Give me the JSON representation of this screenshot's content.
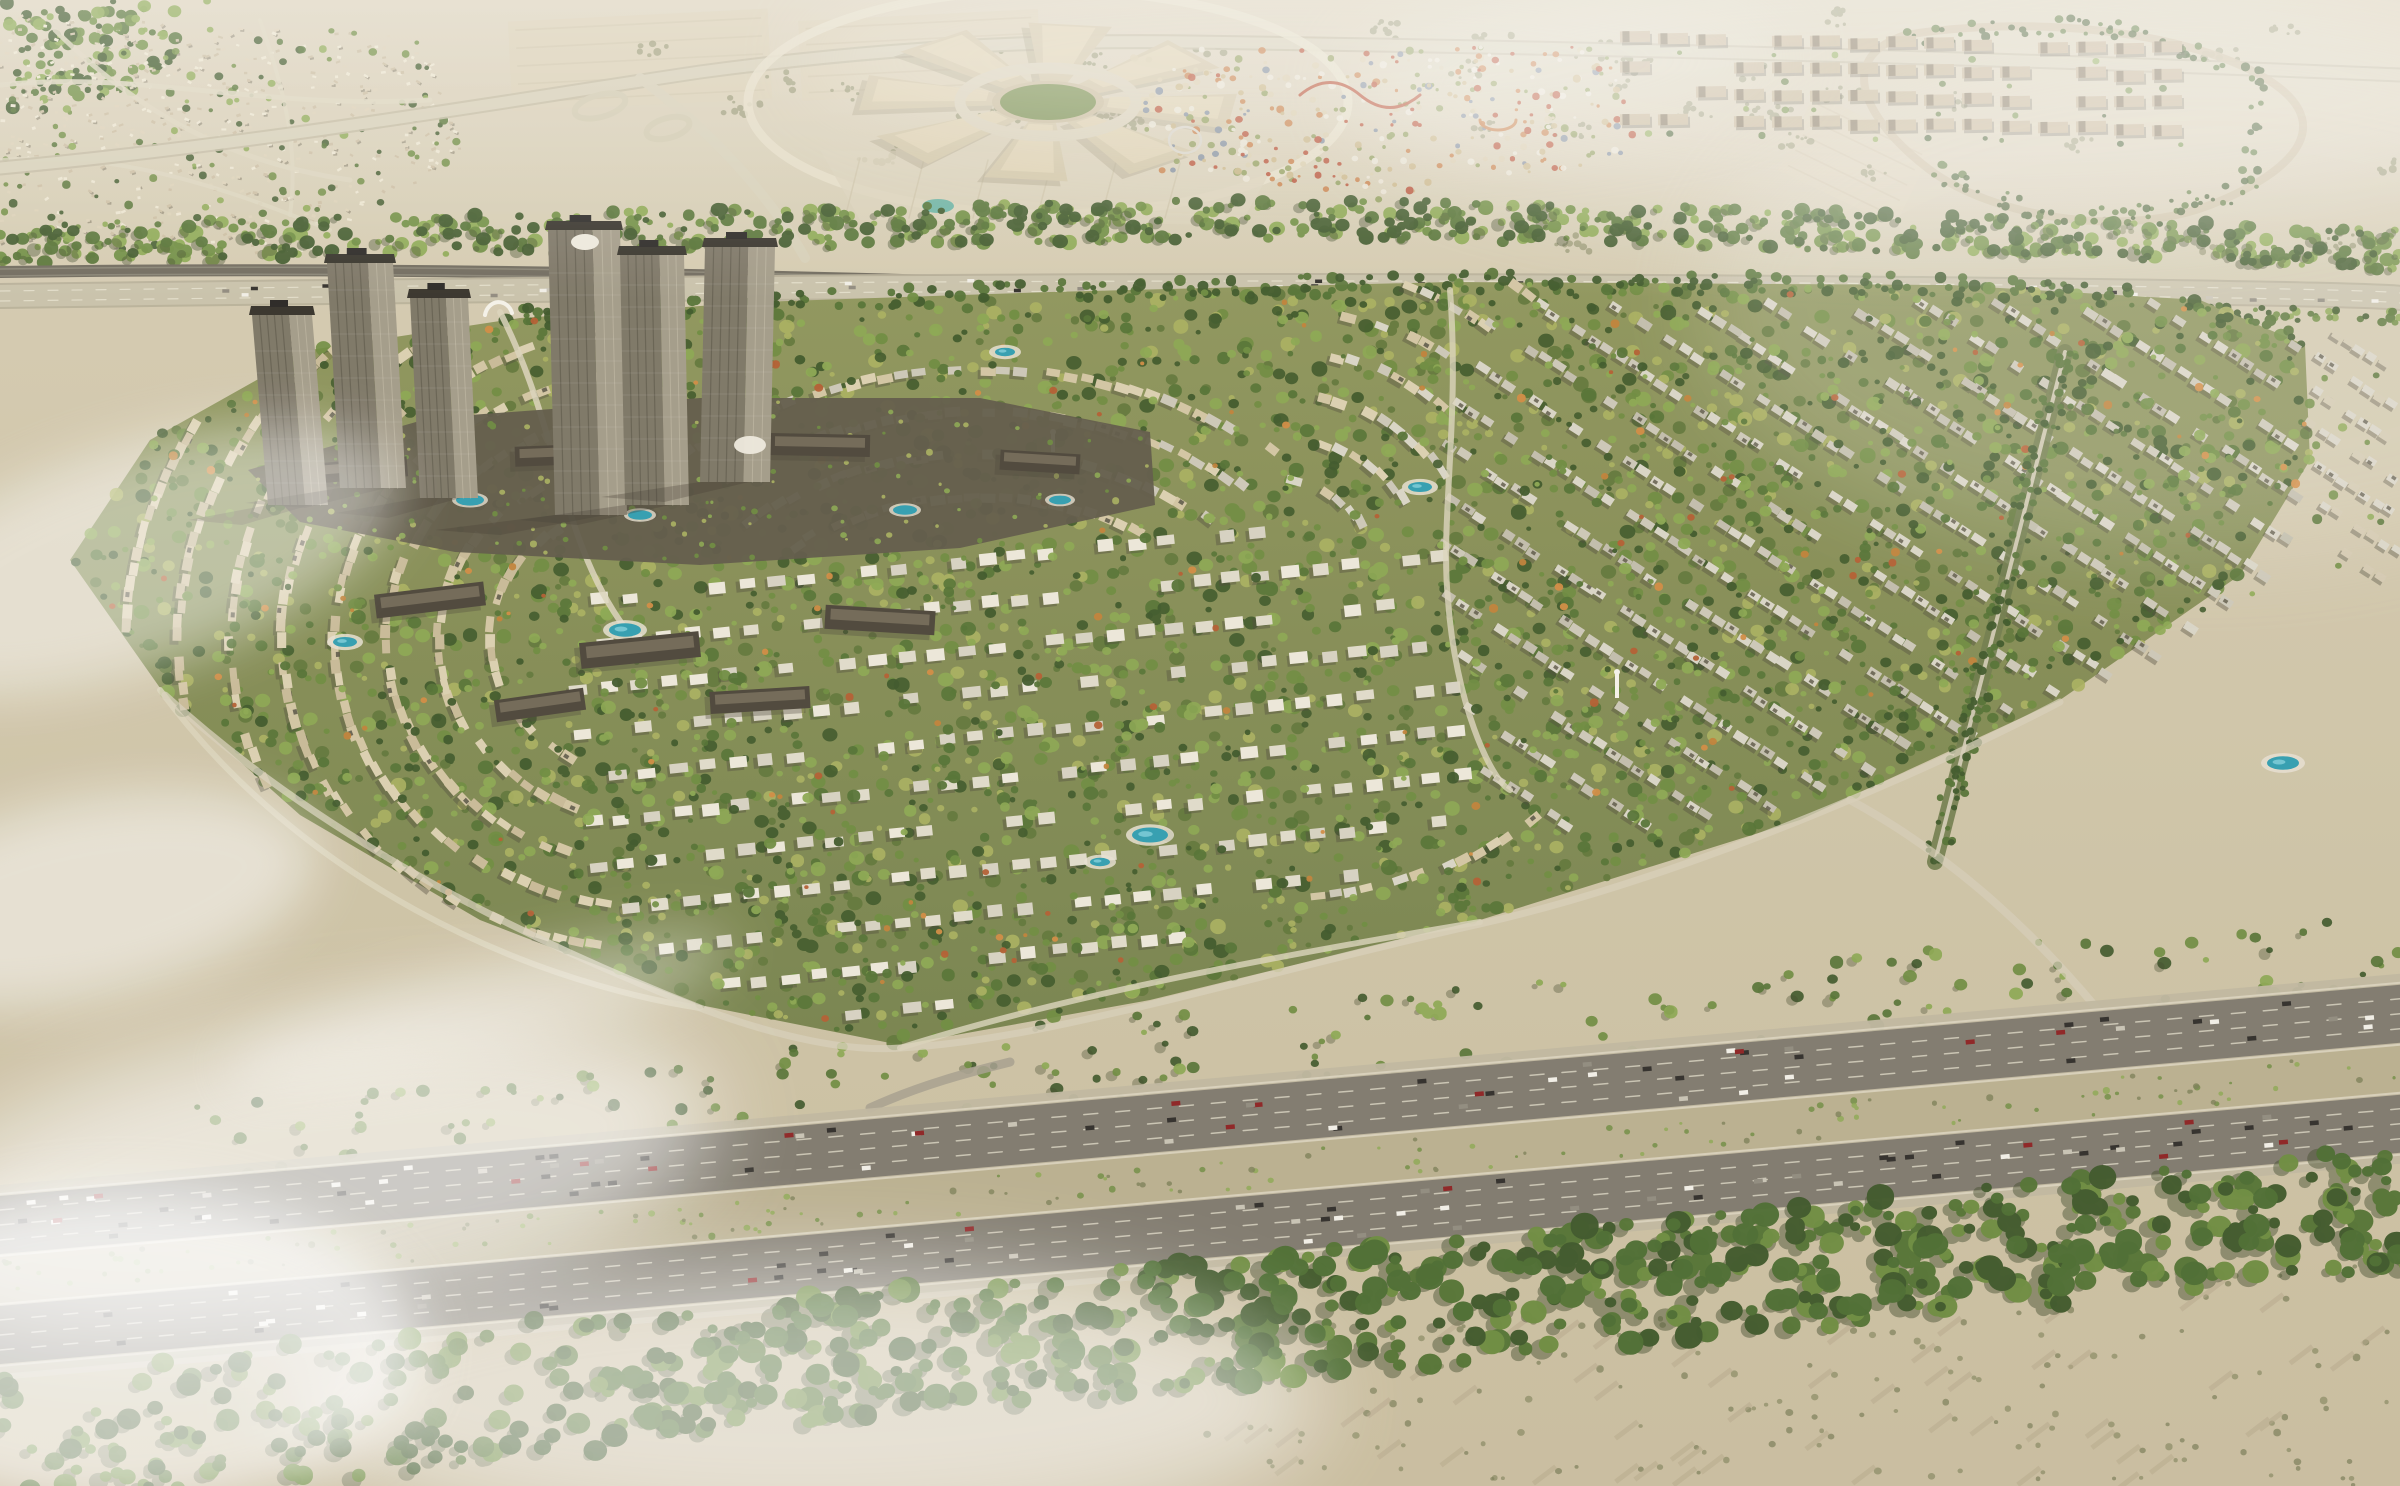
{
  "image": {
    "type": "aerial-architectural-render",
    "description": "Aerial render of a large master-planned desert residential community: crescent-shaped rows of beige townhouses and white villas with dense green landscaping, a cluster of high-rise towers on a podium beside a metro rail line, a circular shopping mall and colorful theme park on the upper desert plain, an eight-lane highway with heavy traffic and a forest belt in the foreground, with haze and low clouds at the edges.",
    "width": 2400,
    "height": 1486
  },
  "palette": {
    "sandTop": "#dad0b8",
    "sand": "#cfc5a9",
    "sandWarm": "#d7c9ac",
    "sandBottom": "#c9bc9e",
    "oliveField": "#abaa7c",
    "oliveField2": "#b7b488",
    "treeDark": "#3c5526",
    "tree": "#527030",
    "treeMid": "#6b8a3c",
    "treeLight": "#8aa64e",
    "treeYellow": "#a9af5c",
    "autumn": "#c07f35",
    "autumnRed": "#b25b2d",
    "communityBase1": "#8e9459",
    "communityBase2": "#76814a",
    "houseBeige1": "#dbcfae",
    "houseBeige2": "#d2c4a1",
    "houseBeige3": "#c8b995",
    "houseGray1": "#d9d4c5",
    "houseGray2": "#ccc7b6",
    "houseGray3": "#c1bcaa",
    "villaWhite1": "#ece7d8",
    "villaWhite2": "#e0dbc9",
    "villaWhite3": "#d6d1c0",
    "roofDark": "#55503f",
    "shadow": "#4b4636",
    "roadLight": "#dcd4bb",
    "roadCasing": "#c2b99e",
    "roadTop": "#d7cfb6",
    "asphalt": "#7e786b",
    "asphaltShoulder": "#bfb69e",
    "laneLine": "#e9e3cf",
    "railDark": "#6e685a",
    "stationGray": "#a39c88",
    "towerFront": "#7b7463",
    "towerSide": "#a29a86",
    "towerCap": "#332f26",
    "towerStripe": "#575243",
    "podium": "#5e5746",
    "podiumBar": "#4a4336",
    "podiumBarTop": "#6f6653",
    "mallBody": "#d2c5a5",
    "mallTop": "#ddd0af",
    "mallRing": "#d9d0b7",
    "mallGreen": "#7a8f4e",
    "mallShadow": "#9d9176",
    "parkOrange": "#c77a40",
    "parkRed": "#b64a2e",
    "parkWhite": "#e9e2d1",
    "parkBlue": "#7d8a9a",
    "pool": "#2f9cae",
    "poolLight": "#7fd0da",
    "poolDeck": "#e6dfd0",
    "pond": "#5fae9e",
    "carDark": "#2e2b26",
    "carWhite": "#f2efe6",
    "carGray": "#8f897c",
    "carRed": "#8c1f1f",
    "carSilver": "#c8c2b3",
    "fog": "#ffffff",
    "haze": "#f3eee1",
    "shrub": "#7a7d54",
    "medianScrub": "#b9ae8d",
    "fieldLine": "#cfc3a6",
    "archWhite": "#f5f2e8"
  },
  "scene": {
    "regions": [
      {
        "id": "desert-plain",
        "label": "hazy desert plain with shrub patches"
      },
      {
        "id": "existing-community",
        "label": "existing villa community at top left"
      },
      {
        "id": "highway-interchange",
        "label": "road interchange with loop ramps"
      },
      {
        "id": "shopping-mall",
        "label": "radial shopping mall with central ring"
      },
      {
        "id": "theme-park",
        "label": "theme park with colorful rides"
      },
      {
        "id": "apartment-rows",
        "label": "rows of tan apartment blocks"
      },
      {
        "id": "tree-belt",
        "label": "green tree belt along the corridor"
      },
      {
        "id": "metro-rail",
        "label": "metro rail line and arterial road"
      },
      {
        "id": "tower-cluster",
        "label": "high-rise towers on podium with pools"
      },
      {
        "id": "villa-community",
        "label": "master-planned community with crescent streets"
      },
      {
        "id": "main-highway",
        "label": "eight-lane highway with traffic and scrub median"
      },
      {
        "id": "forest-belt",
        "label": "dense forest belt in foreground"
      },
      {
        "id": "fog",
        "label": "low clouds and haze"
      }
    ],
    "counts": {
      "mottleDots": 2800,
      "communityTrees": 950,
      "autumnTrees": 170,
      "beltTrees": 760,
      "hedgeTrees": 260,
      "forestTrees": 650,
      "forestTreesLeft": 130,
      "stripTrees": 170,
      "desertShrubClusters": 46,
      "parkDots": 380,
      "existingHouses": 520,
      "existingTrees": 150,
      "cornerTrees": 110,
      "highwayCars": 150,
      "corridorCars": 55,
      "medianScrubDots": 170,
      "podiumRoofDots": 150,
      "bottomBushes": 160
    },
    "leftArcs": {
      "cx": 660,
      "cy": 640,
      "radii": [
        170,
        222,
        274,
        326,
        378,
        430,
        482,
        534
      ],
      "a0": 100,
      "a1": 268
    },
    "rightArcs": {
      "cx": 1270,
      "cy": 560,
      "radii": [
        100,
        152,
        204,
        256,
        308,
        360,
        412
      ],
      "a0": -75,
      "a1": 110
    },
    "northArcs": {
      "cx": 980,
      "cy": 760,
      "radii": [
        320,
        372,
        424,
        476
      ],
      "a0": -128,
      "a1": -52
    },
    "highway": {
      "y0": 1280,
      "slope": -0.088,
      "carriagewayOffset": 55,
      "carriagewayWidth": 58,
      "medianWidth": 48
    }
  }
}
